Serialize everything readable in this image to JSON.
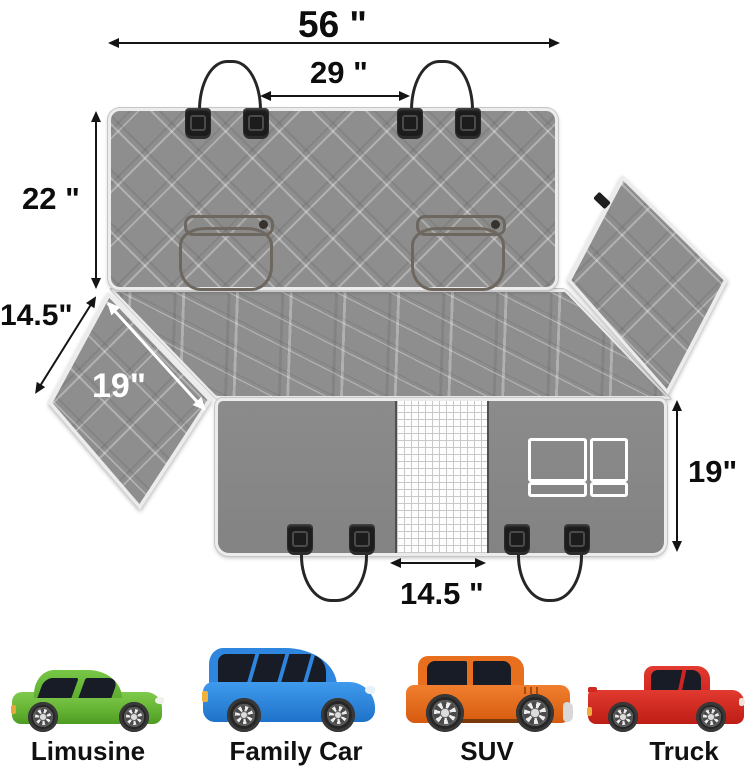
{
  "diagram": {
    "type": "product-dimension-diagram",
    "measurements": {
      "top_width": "56 \"",
      "headrest_strap_gap": "29 \"",
      "backrest_height": "22 \"",
      "side_flap_edge": "14.5\"",
      "side_flap_diagonal": "19\"",
      "front_panel_height": "19\"",
      "mesh_window_width": "14.5 \""
    },
    "features": {
      "belt_openings_count": 2,
      "headrest_buckles_count": 4,
      "seat_anchor_buckles_count": 4,
      "mesh_window": "white mesh strip",
      "pocket": "white stitched pocket outline"
    },
    "colors": {
      "quilted_fabric": "#8e8e8e",
      "front_panel": "#878787",
      "trim": "#ececec",
      "arrow": "#141414",
      "flap_arrow": "#ffffff",
      "strap": "#262626",
      "belt_loop_outline": "#6e6760"
    }
  },
  "compatibility": {
    "vehicles": [
      {
        "label": "Limusine",
        "icon": "sedan-car-icon",
        "color": "#66b434"
      },
      {
        "label": "Family Car",
        "icon": "minivan-car-icon",
        "color": "#2e86de"
      },
      {
        "label": "SUV",
        "icon": "suv-car-icon",
        "color": "#e76f1d"
      },
      {
        "label": "Truck",
        "icon": "pickup-truck-icon",
        "color": "#d8251d"
      }
    ]
  }
}
